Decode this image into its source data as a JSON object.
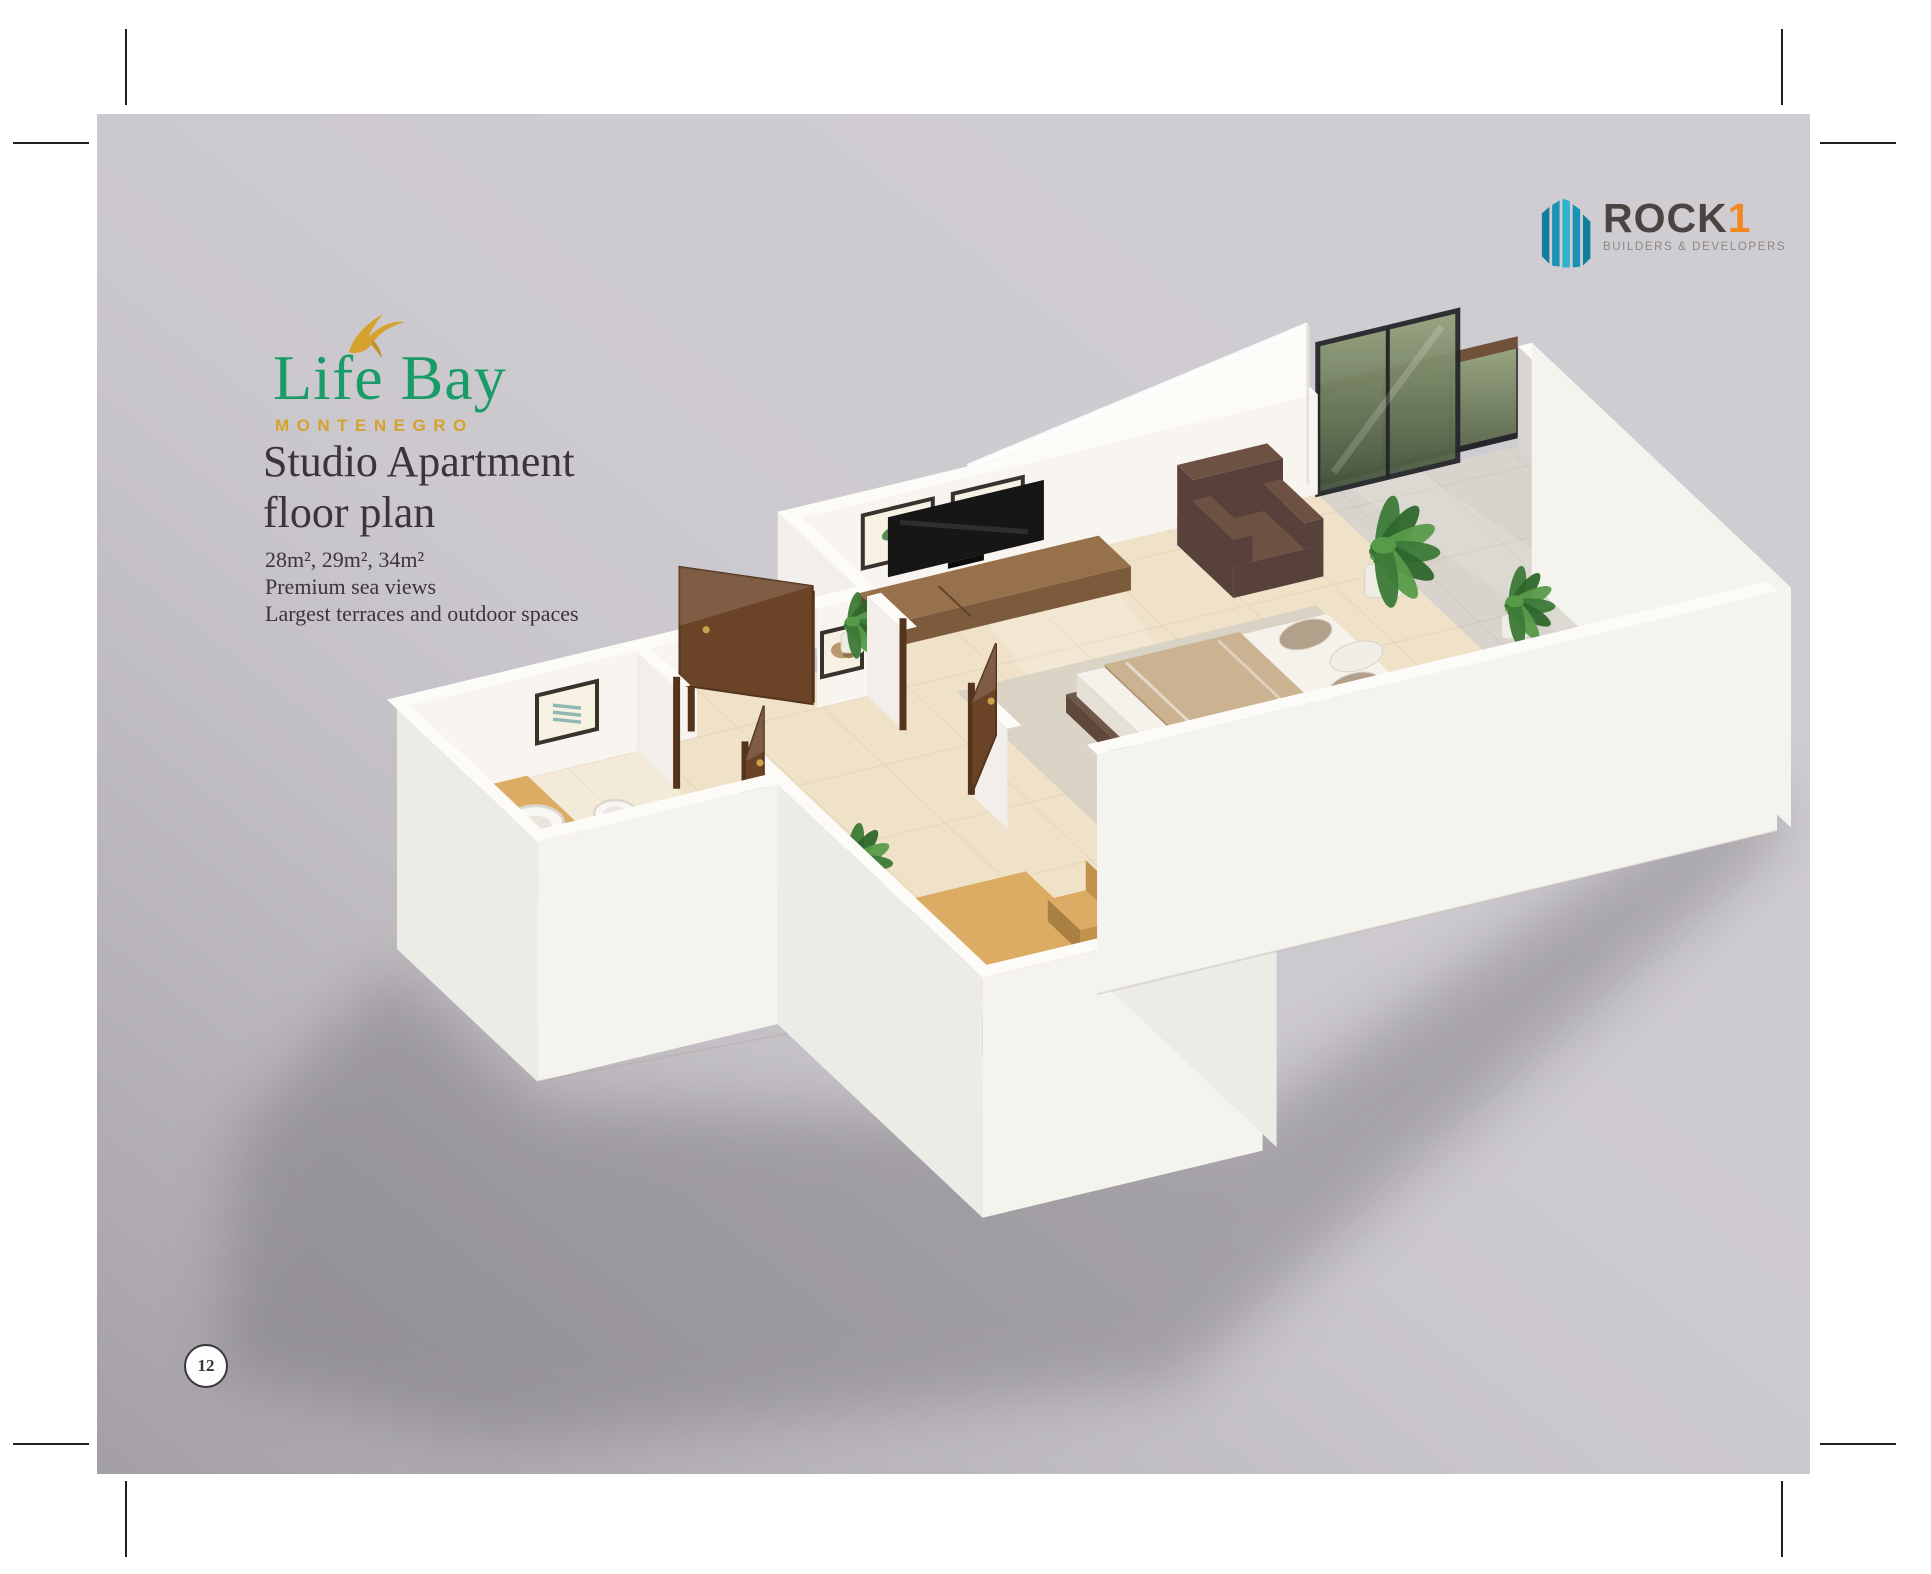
{
  "page": {
    "background_color": "#d0cdd2",
    "outside_color": "#ffffff",
    "page_number": "12"
  },
  "brand": {
    "title": "Life Bay",
    "subtitle": "MONTENEGRO",
    "green": "#1a9c68",
    "gold": "#d5a22e"
  },
  "developer": {
    "name": "ROCK",
    "one": "1",
    "tagline": "BUILDERS & DEVELOPERS",
    "teal": "#2fb0cc",
    "teal_dark": "#117e9d",
    "text_color": "#4a4542",
    "one_color": "#f08921"
  },
  "heading": {
    "line1": "Studio Apartment",
    "line2": "floor plan"
  },
  "specs": [
    "28m², 29m², 34m²",
    "Premium sea views",
    "Largest terraces and outdoor spaces"
  ],
  "floorplan": {
    "alt": "3D isometric cutaway floor plan of a studio apartment: bathroom with vanity basin and toilet, entry hallway with open walnut doors, kitchen-dining nook, living and sleeping area with bed, TV unit and armchair, and a large glazed terrace with plants",
    "palette": {
      "wallTop": "#fcfbf8",
      "wallInner": "#f8f5f0",
      "wallOuter": "#f5f3ee",
      "wallOuterSW": "#edebe6",
      "partition": "#f2efeb",
      "parapetInner": "#d8d4d2",
      "floorBeige": "#efe2c8",
      "floorLine": "#dfcfae",
      "terrace": "#d8d4cd",
      "terraceLine": "#c6c2bb",
      "door": "#6b4327",
      "doorDark": "#55341d",
      "glassTop": "#97a47f",
      "glassBottom": "#44523b",
      "frameDark": "#26272a",
      "rail": "#70513a",
      "woodLight": "#dcab64",
      "woodMid": "#c2914c",
      "woodDark": "#a97f42",
      "tvUnitTop": "#96714c",
      "tvUnitFront": "#7c5a3c",
      "tvUnitSide": "#63452c",
      "tv": "#161616",
      "chair": "#6d5243",
      "chairDark": "#57413a",
      "bedBase": "#6f584a",
      "mattress": "#f5f2ec",
      "mattressSide": "#e5e0d5",
      "blanket": "#cbb291",
      "blanketSide": "#b39878",
      "pillowTaupe": "#b3a08a",
      "pillowWhite": "#f1eee8",
      "rug": "#d6d0c4",
      "counter": "#223430",
      "counterSide": "#141f1c",
      "plant": "#3c7a38",
      "plantDark": "#2e672c",
      "plantLight": "#579b49",
      "pot": "#efece4",
      "ceramic": "#f9f7f3",
      "ceramicShade": "#ddd8cf",
      "shadow": "#716d74"
    }
  }
}
